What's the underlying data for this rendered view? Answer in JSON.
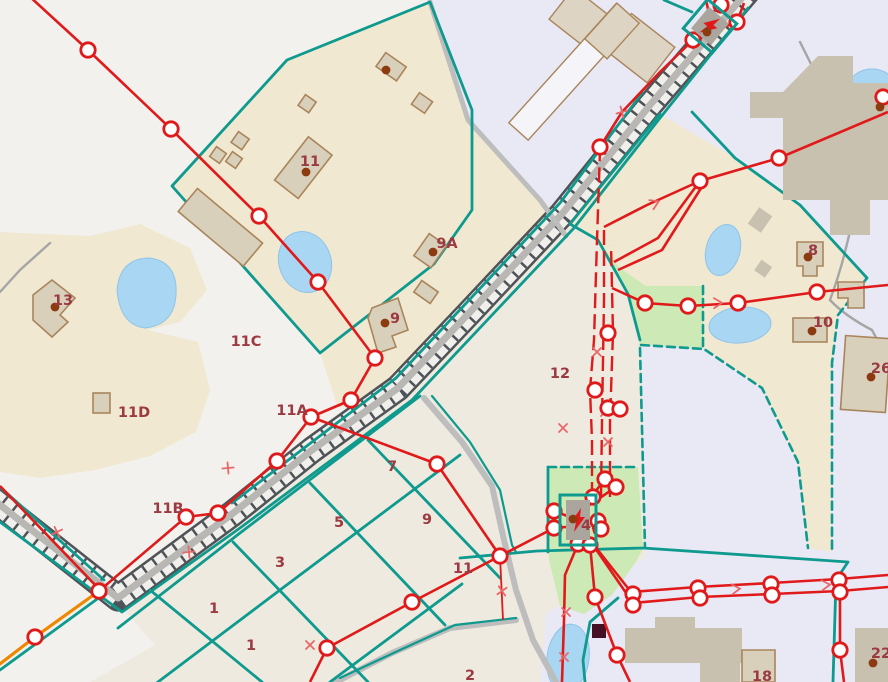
{
  "map": {
    "type": "gis-cadastral-map-canvas",
    "colors": {
      "bg": "#eeeae0",
      "white_zone": "#f2f1ee",
      "lavender": "#e9e8f5",
      "beige": "#f1e8d1",
      "green": "#cde9b5",
      "water": "#a9d6f2",
      "water_edge": "#8fc4e8",
      "teal": "#0e9a8e",
      "red": "#e01a1a",
      "orange": "#ef8800",
      "gray_road": "#bdbdbd",
      "thin_road": "#a5a5a5",
      "band_dark": "#4e5357",
      "band_inner": "#f0efec",
      "band_center": "#b8b7b4",
      "bldg_fill": "#d9d0bc",
      "bldg_stroke": "#a9855c",
      "bldg_flat": "#c9c1b0",
      "bldg_light": "#ded4c3",
      "white_bldg": "#f5f4f8",
      "label": "#9c3a42",
      "dot": "#8c3a10",
      "pole_fill": "#ffffff",
      "dark_square": "#451023",
      "transformer_gray": "#aaa69e",
      "mark": "#e86868"
    },
    "labels": [
      {
        "text": "11",
        "x": 310,
        "y": 166
      },
      {
        "text": "9A",
        "x": 447,
        "y": 248
      },
      {
        "text": "13",
        "x": 63,
        "y": 305
      },
      {
        "text": "11C",
        "x": 246,
        "y": 346
      },
      {
        "text": "11D",
        "x": 134,
        "y": 417
      },
      {
        "text": "9",
        "x": 395,
        "y": 323
      },
      {
        "text": "11A",
        "x": 292,
        "y": 415
      },
      {
        "text": "11B",
        "x": 168,
        "y": 513
      },
      {
        "text": "7",
        "x": 392,
        "y": 471
      },
      {
        "text": "5",
        "x": 339,
        "y": 527
      },
      {
        "text": "9",
        "x": 427,
        "y": 524
      },
      {
        "text": "3",
        "x": 280,
        "y": 567
      },
      {
        "text": "1",
        "x": 214,
        "y": 613
      },
      {
        "text": "1",
        "x": 251,
        "y": 650
      },
      {
        "text": "11",
        "x": 463,
        "y": 573
      },
      {
        "text": "2",
        "x": 470,
        "y": 680
      },
      {
        "text": "12",
        "x": 560,
        "y": 378
      },
      {
        "text": "4",
        "x": 586,
        "y": 530
      },
      {
        "text": "10",
        "x": 823,
        "y": 327
      },
      {
        "text": "26",
        "x": 881,
        "y": 373
      },
      {
        "text": "8",
        "x": 813,
        "y": 255
      },
      {
        "text": "18",
        "x": 762,
        "y": 681
      },
      {
        "text": "22",
        "x": 881,
        "y": 658
      }
    ],
    "poles": [
      [
        88,
        50
      ],
      [
        171,
        129
      ],
      [
        259,
        216
      ],
      [
        318,
        282
      ],
      [
        375,
        358
      ],
      [
        351,
        400
      ],
      [
        311,
        417
      ],
      [
        277,
        461
      ],
      [
        218,
        513
      ],
      [
        186,
        517
      ],
      [
        99,
        591
      ],
      [
        35,
        637
      ],
      [
        437,
        464
      ],
      [
        500,
        556
      ],
      [
        412,
        602
      ],
      [
        327,
        648
      ],
      [
        600,
        147
      ],
      [
        693,
        40
      ],
      [
        737,
        22
      ],
      [
        721,
        5
      ],
      [
        883,
        97
      ],
      [
        779,
        158
      ],
      [
        700,
        181
      ],
      [
        645,
        303
      ],
      [
        688,
        306
      ],
      [
        738,
        303
      ],
      [
        817,
        292
      ],
      [
        608,
        333
      ],
      [
        595,
        390
      ],
      [
        608,
        408
      ],
      [
        620,
        409
      ],
      [
        554,
        511
      ],
      [
        554,
        528
      ],
      [
        593,
        497
      ],
      [
        605,
        479
      ],
      [
        616,
        487
      ],
      [
        598,
        521
      ],
      [
        601,
        529
      ],
      [
        578,
        544
      ],
      [
        590,
        545
      ],
      [
        595,
        597
      ],
      [
        617,
        655
      ],
      [
        633,
        594
      ],
      [
        633,
        605
      ],
      [
        698,
        588
      ],
      [
        700,
        598
      ],
      [
        771,
        584
      ],
      [
        772,
        595
      ],
      [
        839,
        580
      ],
      [
        840,
        592
      ],
      [
        840,
        650
      ]
    ],
    "dots": [
      [
        306,
        172
      ],
      [
        386,
        70
      ],
      [
        433,
        252
      ],
      [
        385,
        323
      ],
      [
        55,
        307
      ],
      [
        871,
        377
      ],
      [
        812,
        331
      ],
      [
        808,
        257
      ],
      [
        873,
        663
      ],
      [
        880,
        107
      ],
      [
        707,
        32
      ],
      [
        573,
        519
      ]
    ],
    "transformers": [
      {
        "x": 710,
        "y": 26,
        "rot": 40,
        "w": 32,
        "h": 32
      },
      {
        "x": 578,
        "y": 520,
        "rot": 0,
        "w": 30,
        "h": 44
      }
    ],
    "marks": [
      {
        "type": "x",
        "x": 57,
        "y": 532,
        "rot": 20
      },
      {
        "type": "x",
        "x": 228,
        "y": 468,
        "rot": 40
      },
      {
        "type": "x",
        "x": 310,
        "y": 645,
        "rot": 0
      },
      {
        "type": "x",
        "x": 502,
        "y": 591,
        "rot": 10
      },
      {
        "type": "x",
        "x": 563,
        "y": 428,
        "rot": 0
      },
      {
        "type": "x",
        "x": 605,
        "y": 412,
        "rot": 0
      },
      {
        "type": "x",
        "x": 566,
        "y": 612,
        "rot": 0
      },
      {
        "type": "x",
        "x": 564,
        "y": 657,
        "rot": 0
      },
      {
        "type": "x",
        "x": 622,
        "y": 112,
        "rot": 30
      },
      {
        "type": "x",
        "x": 597,
        "y": 352,
        "rot": 0
      },
      {
        "type": "x",
        "x": 608,
        "y": 442,
        "rot": 0
      },
      {
        "type": "x",
        "x": 189,
        "y": 552,
        "rot": 40
      },
      {
        "type": "arrow",
        "x": 655,
        "y": 203,
        "rot": 155
      },
      {
        "type": "arrow",
        "x": 718,
        "y": 303,
        "rot": 178
      },
      {
        "type": "arrow",
        "x": 736,
        "y": 589,
        "rot": 175
      },
      {
        "type": "arrow",
        "x": 826,
        "y": 585,
        "rot": 175
      }
    ]
  }
}
